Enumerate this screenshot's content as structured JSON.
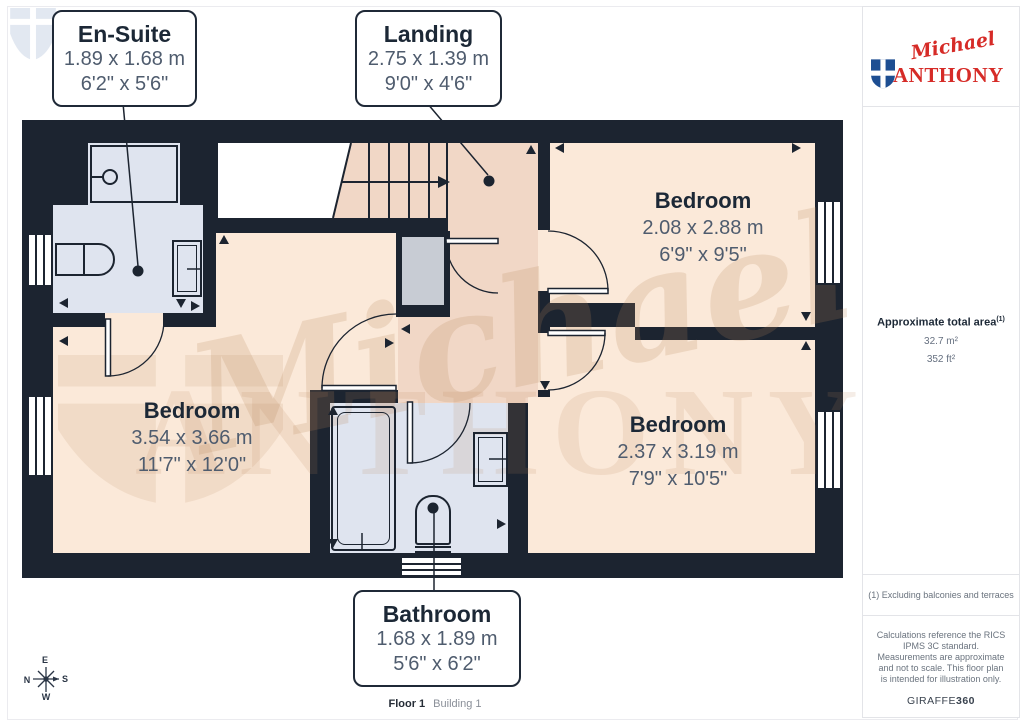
{
  "plan": {
    "callouts": {
      "ensuite": {
        "title": "En-Suite",
        "metric": "1.89 x 1.68 m",
        "imperial": "6'2\" x 5'6\""
      },
      "landing": {
        "title": "Landing",
        "metric": "2.75 x 1.39 m",
        "imperial": "9'0\" x 4'6\""
      },
      "bathroom": {
        "title": "Bathroom",
        "metric": "1.68 x 1.89 m",
        "imperial": "5'6\" x 6'2\""
      }
    },
    "rooms": [
      {
        "name": "Bedroom",
        "metric": "3.54 x 3.66 m",
        "imperial": "11'7\" x 12'0\""
      },
      {
        "name": "Bedroom",
        "metric": "2.08 x 2.88 m",
        "imperial": "6'9\" x 9'5\""
      },
      {
        "name": "Bedroom",
        "metric": "2.37 x 3.19 m",
        "imperial": "7'9\" x 10'5\""
      }
    ],
    "compass": {
      "top": "E",
      "left": "N",
      "right": "S",
      "bottom": "W"
    }
  },
  "watermark": {
    "script": "Michael",
    "caps": "ANTHONY"
  },
  "sidebar": {
    "logo": {
      "script": "Michael",
      "caps": "ANTHONY"
    },
    "area": {
      "title": "Approximate total area",
      "note_ref": "(1)",
      "metric": "32.7 m²",
      "imperial": "352 ft²"
    },
    "footnote": "(1) Excluding balconies and terraces",
    "disclaimer": "Calculations reference the RICS IPMS 3C standard. Measurements are approximate and not to scale. This floor plan is intended for illustration only.",
    "credit": {
      "name": "GIRAFFE",
      "suffix": "360"
    }
  },
  "footer": {
    "floor": "Floor 1",
    "building": "Building 1"
  },
  "colors": {
    "wall": "#1c2430",
    "bedroom_floor": "#fbe9d9",
    "landing_floor": "#f1d7c6",
    "wet_floor": "#dfe4ef",
    "brand_red": "#d62b27",
    "brand_blue": "#1d4e92"
  }
}
